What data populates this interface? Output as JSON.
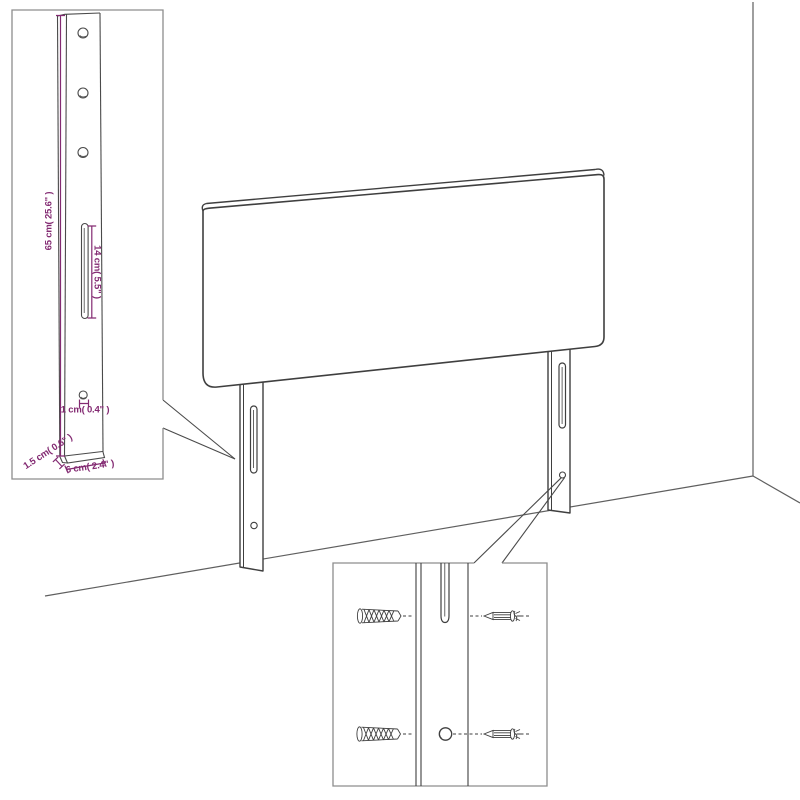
{
  "diagram": {
    "type": "assembly-diagram",
    "colors": {
      "line": "#3f3f3f",
      "wall_line": "#5f5f5f",
      "inset_border": "#8d8d8d",
      "dimension_text": "#832a72",
      "background": "#ffffff"
    },
    "leg_detail_inset": {
      "labels": {
        "height": "65 cm( 25.6\" )",
        "slot_height": "14 cm( 5.5\" )",
        "hole_diameter": "1 cm( 0.4\" )",
        "thickness": "1.5 cm( 0.6\" )",
        "width": "6 cm( 2.4\" )"
      },
      "hole_count": 3
    },
    "mounting_detail_inset": {
      "wall_plug_count": 2,
      "screw_count": 2,
      "target_count": 2
    }
  }
}
